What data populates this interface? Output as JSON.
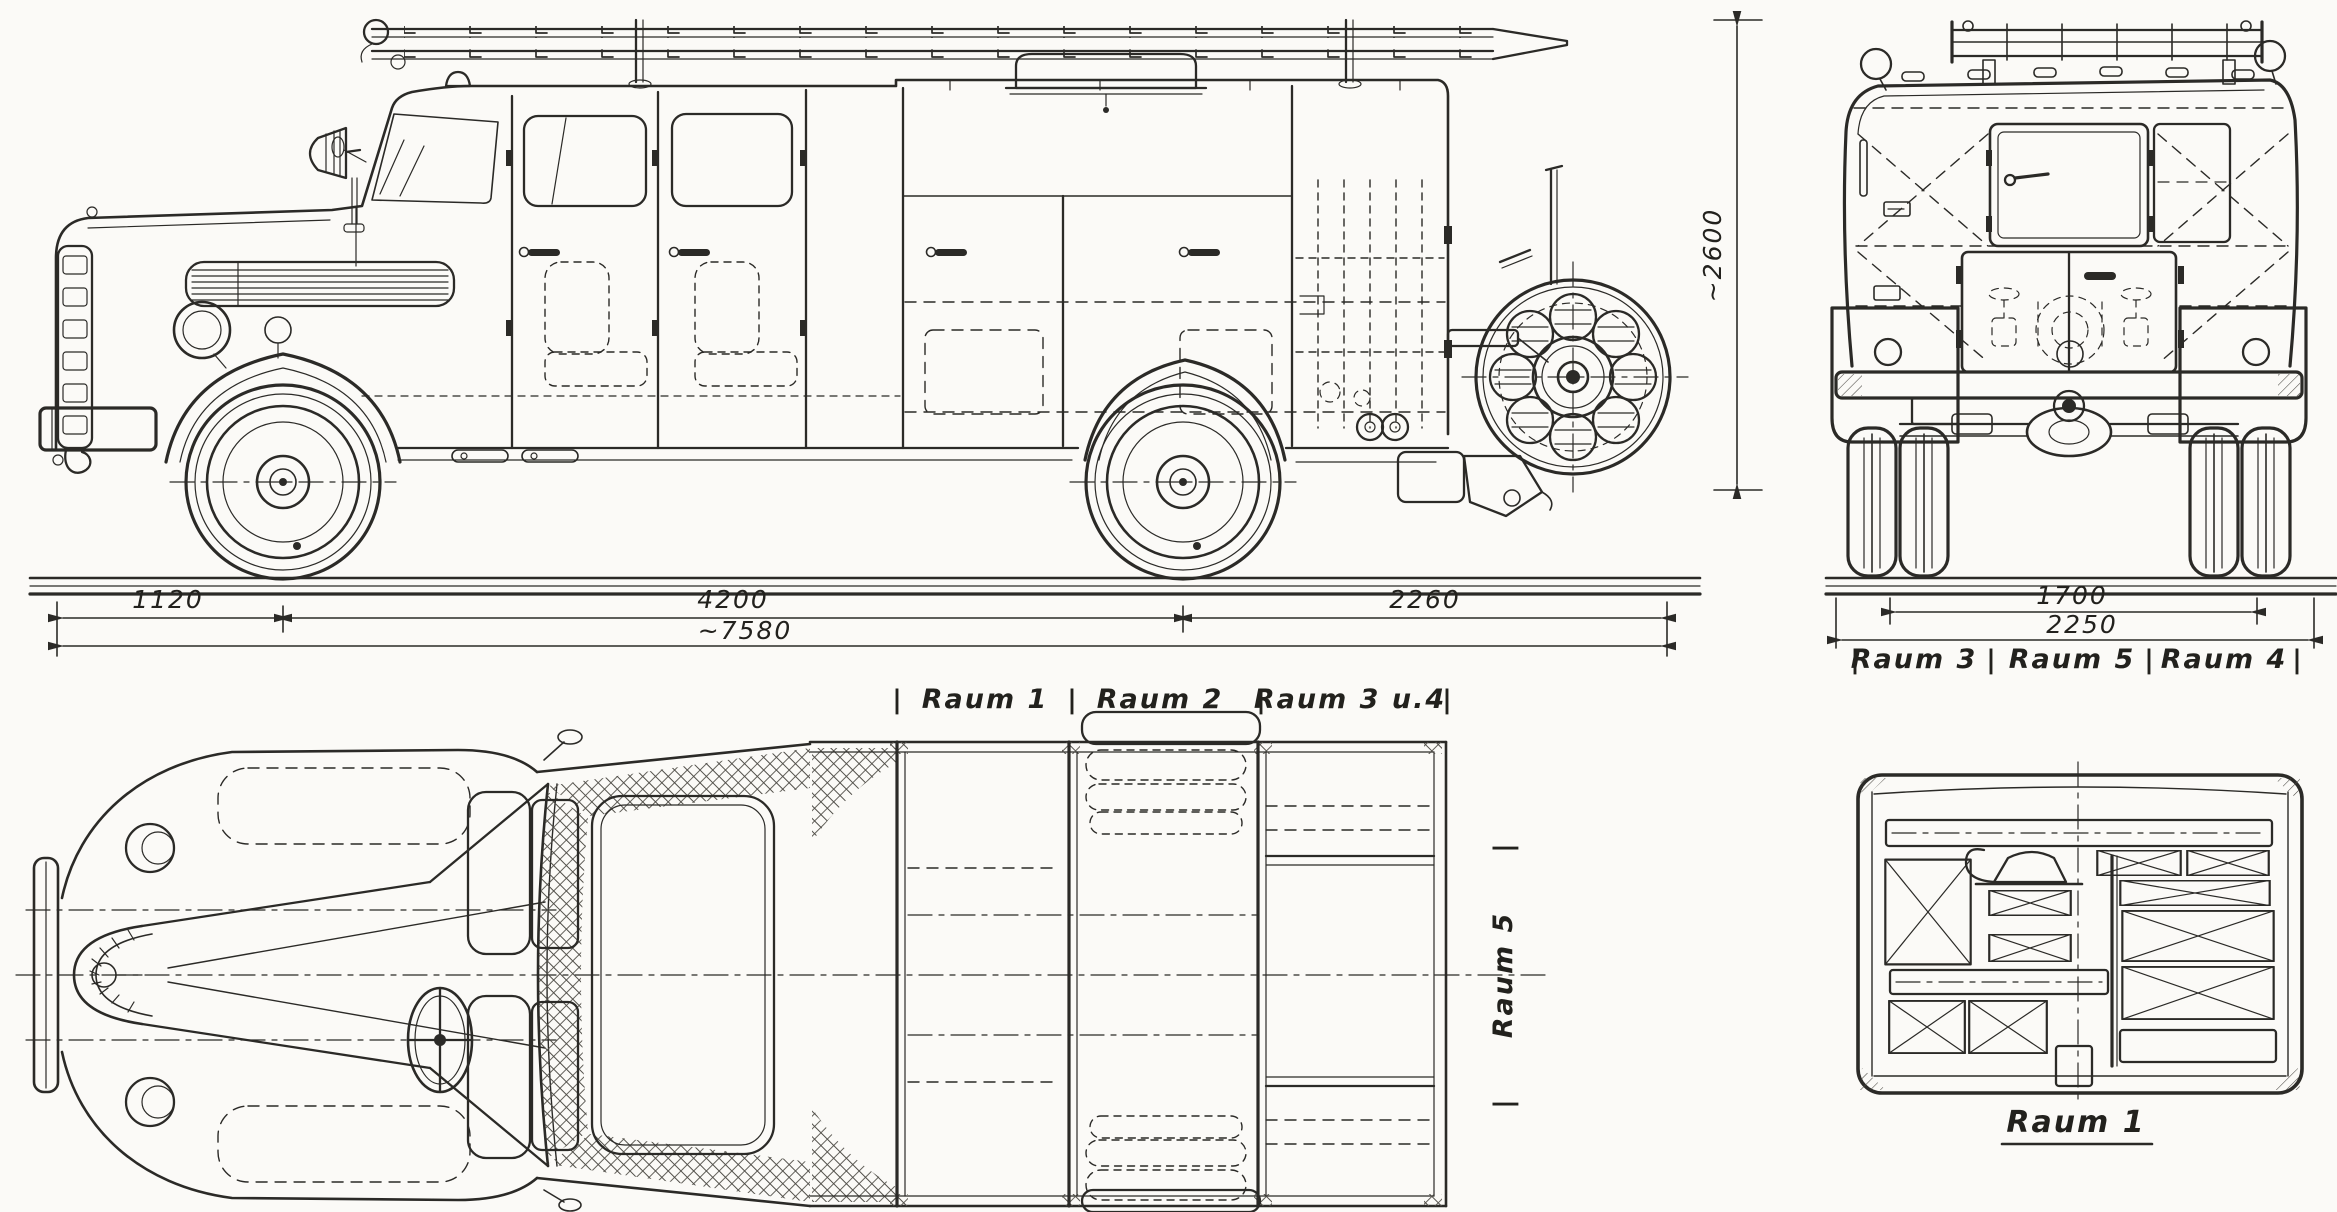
{
  "separator": "|",
  "compartments": {
    "raum1": "Raum 1",
    "raum2": "Raum 2",
    "raum3u4": "Raum 3 u.4",
    "raum5": "Raum 5",
    "raum3": "Raum 3",
    "raum4": "Raum 4",
    "detail_title": "Raum 1"
  },
  "dimensions": {
    "front_overhang": "1120",
    "wheelbase": "4200",
    "rear_overhang": "2260",
    "overall_length": "~7580",
    "overall_height": "~2600",
    "inner_width": "1700",
    "overall_width": "2250"
  },
  "colors": {
    "ink": "#2b2a27",
    "paper": "#fbfaf7"
  }
}
